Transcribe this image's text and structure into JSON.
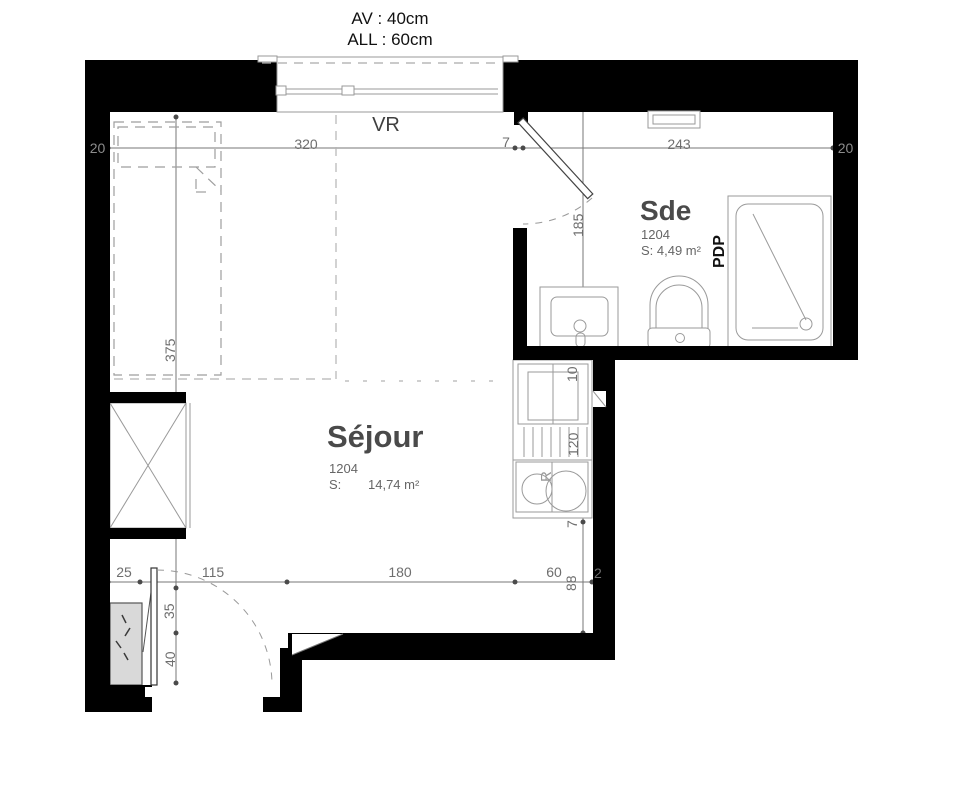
{
  "header": {
    "av": "AV : 40cm",
    "all": "ALL : 60cm",
    "vr": "VR"
  },
  "rooms": {
    "sejour": {
      "name": "Séjour",
      "lot": "1204",
      "area_label": "S:",
      "area": "14,74 m²"
    },
    "sde": {
      "name": "Sde",
      "lot": "1204",
      "area": "S: 4,49 m²",
      "pdp": "PDP"
    }
  },
  "dims": {
    "top_left_wall": "20",
    "top_width": "320",
    "top_door": "7",
    "top_sde": "243",
    "top_right_wall": "20",
    "left_height": "375",
    "sde_height": "185",
    "k10": "10",
    "k120": "120",
    "k7": "7",
    "k88": "88",
    "k2": "2",
    "b25": "25",
    "b115": "115",
    "b180": "180",
    "b60": "60",
    "e35": "35",
    "e40": "40",
    "kitchen_r": "R"
  },
  "colors": {
    "wall": "#000000",
    "dim_line": "#777777",
    "fixture_line": "#9a9a9a",
    "panel_fill": "#d9d9d9"
  }
}
